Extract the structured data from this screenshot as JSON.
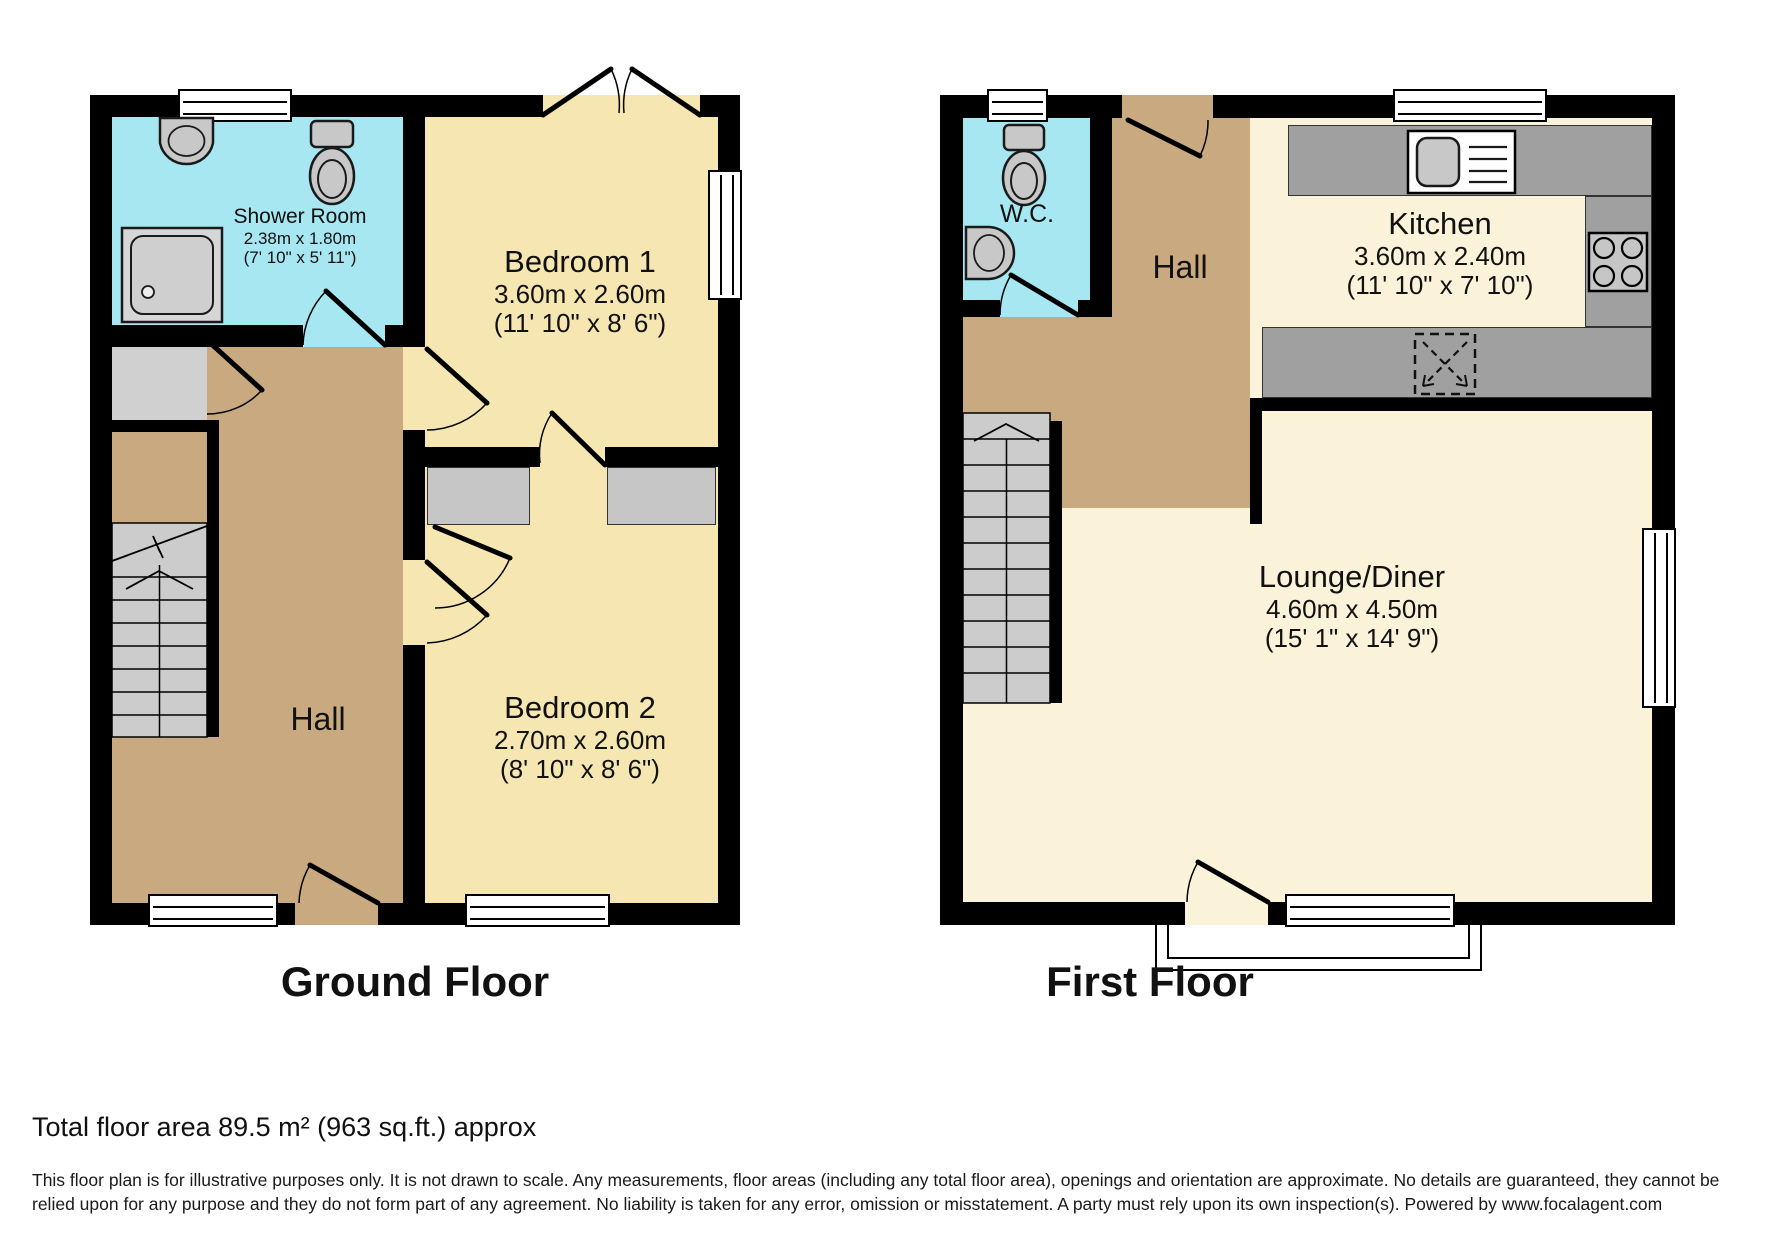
{
  "titles": {
    "ground": "Ground Floor",
    "first": "First Floor"
  },
  "rooms": {
    "shower_room": {
      "name": "Shower Room",
      "metric": "2.38m x 1.80m",
      "imperial": "(7' 10\" x 5' 11\")"
    },
    "bedroom1": {
      "name": "Bedroom 1",
      "metric": "3.60m x 2.60m",
      "imperial": "(11' 10\" x 8' 6\")"
    },
    "bedroom2": {
      "name": "Bedroom 2",
      "metric": "2.70m x 2.60m",
      "imperial": "(8' 10\" x 8' 6\")"
    },
    "hall_ground": {
      "name": "Hall"
    },
    "wc": {
      "name": "W.C."
    },
    "hall_first": {
      "name": "Hall"
    },
    "kitchen": {
      "name": "Kitchen",
      "metric": "3.60m x 2.40m",
      "imperial": "(11' 10\" x 7' 10\")"
    },
    "lounge_diner": {
      "name": "Lounge/Diner",
      "metric": "4.60m x 4.50m",
      "imperial": "(15' 1\" x 14' 9\")"
    }
  },
  "footer": {
    "total_area": "Total floor area 89.5 m² (963 sq.ft.) approx",
    "disclaimer": "This floor plan is for illustrative purposes only. It is not drawn to scale. Any measurements, floor areas (including any total floor area), openings and orientation are approximate. No details are guaranteed, they cannot be relied upon for any purpose and they do not form part of any agreement. No liability is taken for any error, omission or misstatement. A party must rely upon its own inspection(s). Powered by www.focalagent.com"
  },
  "colors": {
    "wall": "#000000",
    "bedroom_floor": "#F6E7B2",
    "living_floor": "#FAF3DA",
    "hall_floor": "#C9AA80",
    "bathroom_floor": "#A6E7F2",
    "fixture_gray": "#C8C8C8",
    "counter_gray": "#A0A0A0",
    "stairs_gray": "#CCCCCC"
  }
}
